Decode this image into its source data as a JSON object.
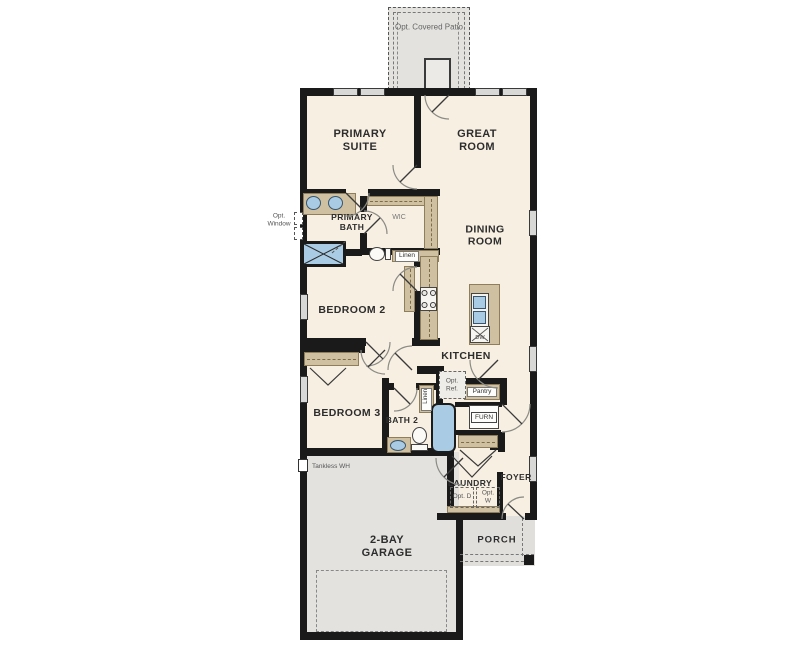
{
  "labels": {
    "patio": "Opt. Covered Patio",
    "primary_suite": "PRIMARY SUITE",
    "great_room": "GREAT ROOM",
    "primary_bath": "PRIMARY BATH",
    "wic": "WIC",
    "opt_window": "Opt. Window",
    "dining_room": "DINING ROOM",
    "linen_upper": "Linen",
    "bedroom2": "BEDROOM 2",
    "kitchen": "KITCHEN",
    "dw": "DW",
    "bedroom3": "BEDROOM 3",
    "bath2": "BATH 2",
    "linen_lower": "Linen",
    "opt_ref": "Opt. Ref.",
    "pantry": "Pantry",
    "furn": "FURN",
    "tankless_wh": "Tankless WH",
    "laundry": "LAUNDRY",
    "opt_d": "Opt. D",
    "opt_w": "Opt. W",
    "foyer": "FOYER",
    "garage": "2-BAY GARAGE",
    "porch": "PORCH"
  },
  "colors": {
    "wall": "#1a1a1a",
    "interior_floor": "#f7efe2",
    "concrete_floor": "#e3e2df",
    "casework_tan": "#cfc0a1",
    "plumbing_blue": "#a9cbe3",
    "window_gray": "#d8d8d6"
  }
}
